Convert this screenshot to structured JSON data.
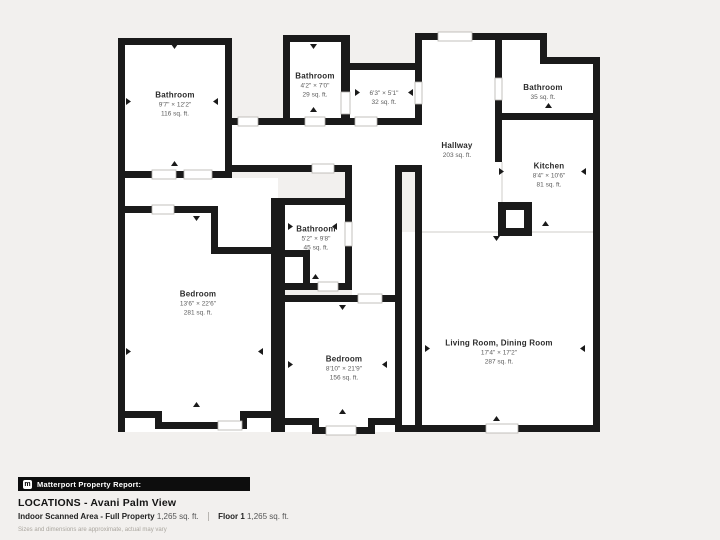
{
  "colors": {
    "background": "#f2f0ee",
    "wall": "#1a1a1a",
    "room_fill": "#ffffff",
    "text_primary": "#2b2b2b",
    "text_secondary": "#5d5d5d",
    "report_bar": "#0d0d0d"
  },
  "rooms": [
    {
      "id": "bathroom-top-left",
      "name": "Bathroom",
      "dims": "9'7\" × 12'2\"",
      "area": "116 sq. ft."
    },
    {
      "id": "bathroom-small-top",
      "name": "Bathroom",
      "dims": "4'2\" × 7'0\"",
      "area": "29 sq. ft."
    },
    {
      "id": "room-unnamed",
      "name": "",
      "dims": "6'3\" × 5'1\"",
      "area": "32 sq. ft."
    },
    {
      "id": "bathroom-top-right",
      "name": "Bathroom",
      "dims": "",
      "area": "35 sq. ft."
    },
    {
      "id": "hallway",
      "name": "Hallway",
      "dims": "",
      "area": "203 sq. ft."
    },
    {
      "id": "kitchen",
      "name": "Kitchen",
      "dims": "8'4\" × 10'6\"",
      "area": "81 sq. ft."
    },
    {
      "id": "bathroom-middle",
      "name": "Bathroom",
      "dims": "5'2\" × 9'8\"",
      "area": "45 sq. ft."
    },
    {
      "id": "bedroom-left",
      "name": "Bedroom",
      "dims": "13'6\" × 22'6\"",
      "area": "281 sq. ft."
    },
    {
      "id": "bedroom-middle",
      "name": "Bedroom",
      "dims": "8'10\" × 21'9\"",
      "area": "156 sq. ft."
    },
    {
      "id": "living-dining",
      "name": "Living Room, Dining Room",
      "dims": "17'4\" × 17'2\"",
      "area": "287 sq. ft."
    }
  ],
  "footer": {
    "logo_glyph": "m",
    "report_label": "Matterport Property Report:",
    "title": "LOCATIONS - Avani Palm View",
    "scanned_label": "Indoor Scanned Area - Full Property",
    "scanned_value": "1,265 sq. ft.",
    "floor_label": "Floor 1",
    "floor_value": "1,265 sq. ft.",
    "disclaimer": "Sizes and dimensions are approximate, actual may vary"
  }
}
